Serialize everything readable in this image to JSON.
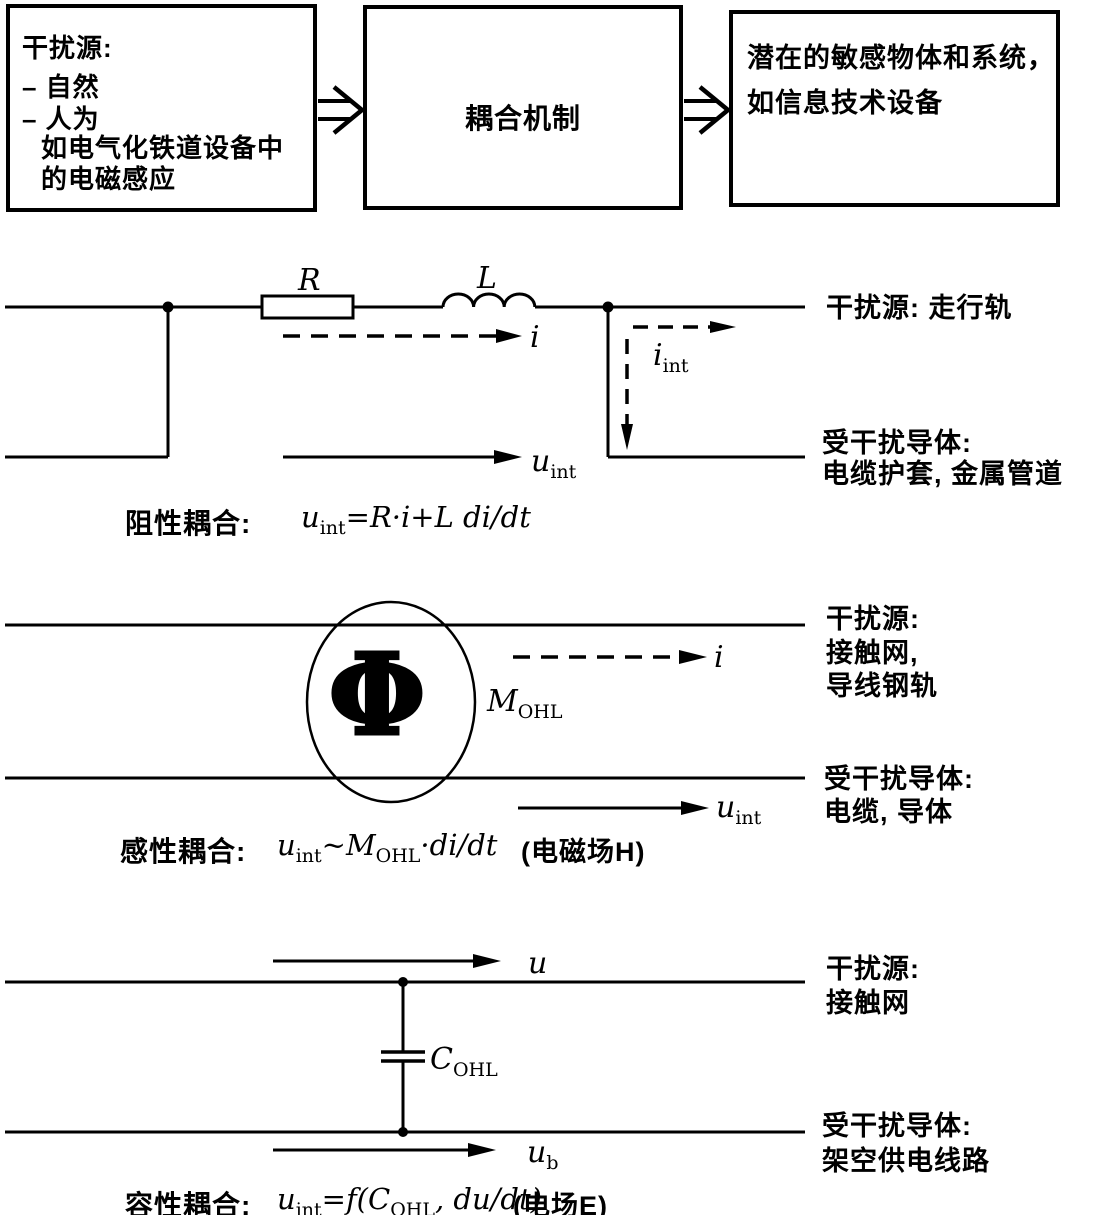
{
  "colors": {
    "ink": "#000000",
    "paper": "#ffffff"
  },
  "flow": {
    "source_box": {
      "title": "干扰源:",
      "item1": "– 自然",
      "item2": "– 人为",
      "example1": "如电气化铁道设备中",
      "example2": "的电磁感应"
    },
    "coupling_box": {
      "label": "耦合机制"
    },
    "victim_box": {
      "line1": "潜在的敏感物体和系统，",
      "line2": "如信息技术设备"
    }
  },
  "resistive": {
    "r_label": "R",
    "l_label": "L",
    "i_label": "i",
    "i_int": {
      "base": "i",
      "sub": "int"
    },
    "u_int": {
      "base": "u",
      "sub": "int"
    },
    "source_label": "干扰源: 走行轨",
    "victim_line1": "受干扰导体:",
    "victim_line2": "电缆护套, 金属管道",
    "formula": {
      "title": "阻性耦合:",
      "u": "u",
      "u_sub": "int",
      "rest": "=R·i+L di/dt"
    }
  },
  "inductive": {
    "i_label": "i",
    "flux_symbol": "Φ",
    "m_ohl": {
      "base": "M",
      "sub": "OHL"
    },
    "u_int": {
      "base": "u",
      "sub": "int"
    },
    "source_line1": "干扰源:",
    "source_line2": "接触网,",
    "source_line3": "导线钢轨",
    "victim_line1": "受干扰导体:",
    "victim_line2": "电缆, 导体",
    "formula": {
      "title": "感性耦合:",
      "u": "u",
      "u_sub": "int",
      "rest1": "~M",
      "m_sub": "OHL",
      "rest2": "·di/dt",
      "note": "(电磁场H)"
    }
  },
  "capacitive": {
    "u_label": "u",
    "c_ohl": {
      "base": "C",
      "sub": "OHL"
    },
    "u_b": {
      "base": "u",
      "sub": "b"
    },
    "source_line1": "干扰源:",
    "source_line2": "接触网",
    "victim_line1": "受干扰导体:",
    "victim_line2": "架空供电线路",
    "formula": {
      "title": "容性耦合:",
      "u": "u",
      "u_sub": "int",
      "rest1": "=f(C",
      "c_sub": "OHL",
      "rest2": ", du/dt)",
      "note": "(电场E)"
    }
  }
}
